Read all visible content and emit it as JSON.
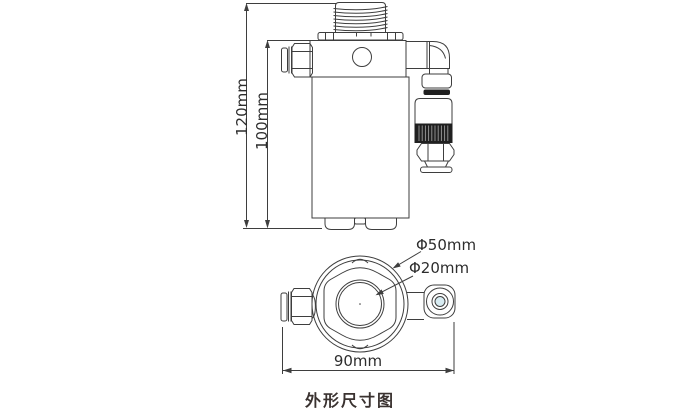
{
  "caption": "外形尺寸图",
  "front_view": {
    "height_overall": "120mm",
    "height_body": "100mm"
  },
  "top_view": {
    "outer_diameter": "Φ50mm",
    "port_diameter": "Φ20mm",
    "width_overall": "90mm"
  },
  "colors": {
    "line": "#3e3e3e",
    "dark_band": "#202020",
    "port_tint": "#d8ecf2",
    "text": "#2d2d2d",
    "caption_text": "#3a3230",
    "background": "#ffffff"
  }
}
